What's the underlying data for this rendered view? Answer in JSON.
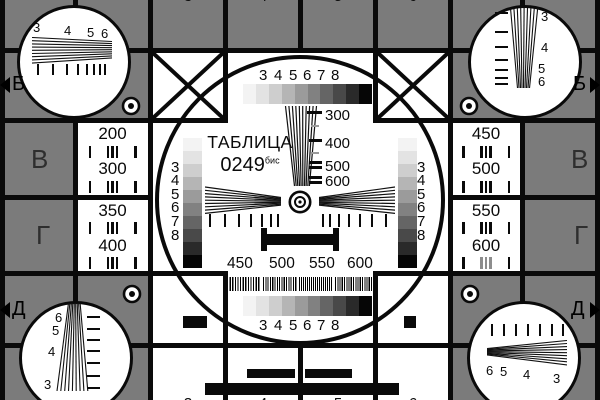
{
  "title": {
    "name": "ТАБЛИЦА",
    "number": "0249",
    "suffix": "бис"
  },
  "colors": {
    "background": "#7b7b7b",
    "ink": "#0a0a0a",
    "white": "#ffffff",
    "row_letter": "#2e2e2e",
    "grayscale": [
      "#f3f3f3",
      "#e3e3e3",
      "#cecece",
      "#b5b5b5",
      "#9b9b9b",
      "#818181",
      "#656565",
      "#494949",
      "#2a2a2a",
      "#060606"
    ]
  },
  "circle": {
    "top_scale": [
      "3",
      "4",
      "5",
      "6",
      "7",
      "8"
    ],
    "bottom_scale": [
      "3",
      "4",
      "5",
      "6",
      "7",
      "8"
    ],
    "left_scale": [
      "3",
      "4",
      "5",
      "6",
      "7",
      "8"
    ],
    "right_scale": [
      "3",
      "4",
      "5",
      "6",
      "7",
      "8"
    ],
    "wedge_marks": [
      "300",
      "400",
      "500",
      "600"
    ],
    "freq_marks": [
      "450",
      "500",
      "550",
      "600"
    ]
  },
  "cells": {
    "left_row_v": [
      "200",
      "300"
    ],
    "left_row_g": [
      "350",
      "400"
    ],
    "right_row_v": [
      "450",
      "500"
    ],
    "right_row_g": [
      "550",
      "600"
    ]
  },
  "corners": {
    "top_left": [
      "3",
      "4",
      "5",
      "6"
    ],
    "top_right": [
      "3",
      "4",
      "5",
      "6"
    ],
    "bottom_left": [
      "6",
      "5",
      "4",
      "3"
    ],
    "bottom_right": [
      "6",
      "5",
      "4",
      "3"
    ]
  },
  "edge": {
    "marker_top_left": "Б",
    "marker_top_right": "Б",
    "marker_bottom_left": "Д",
    "marker_bottom_right": "Д",
    "row_letter_left_v": "В",
    "row_letter_left_g": "Г",
    "row_letter_right_v": "В",
    "row_letter_right_g": "Г",
    "cut_digits_top": [
      "3",
      "4",
      "5",
      "6"
    ],
    "cut_digits_bottom": [
      "3",
      "4",
      "5",
      "6"
    ]
  }
}
